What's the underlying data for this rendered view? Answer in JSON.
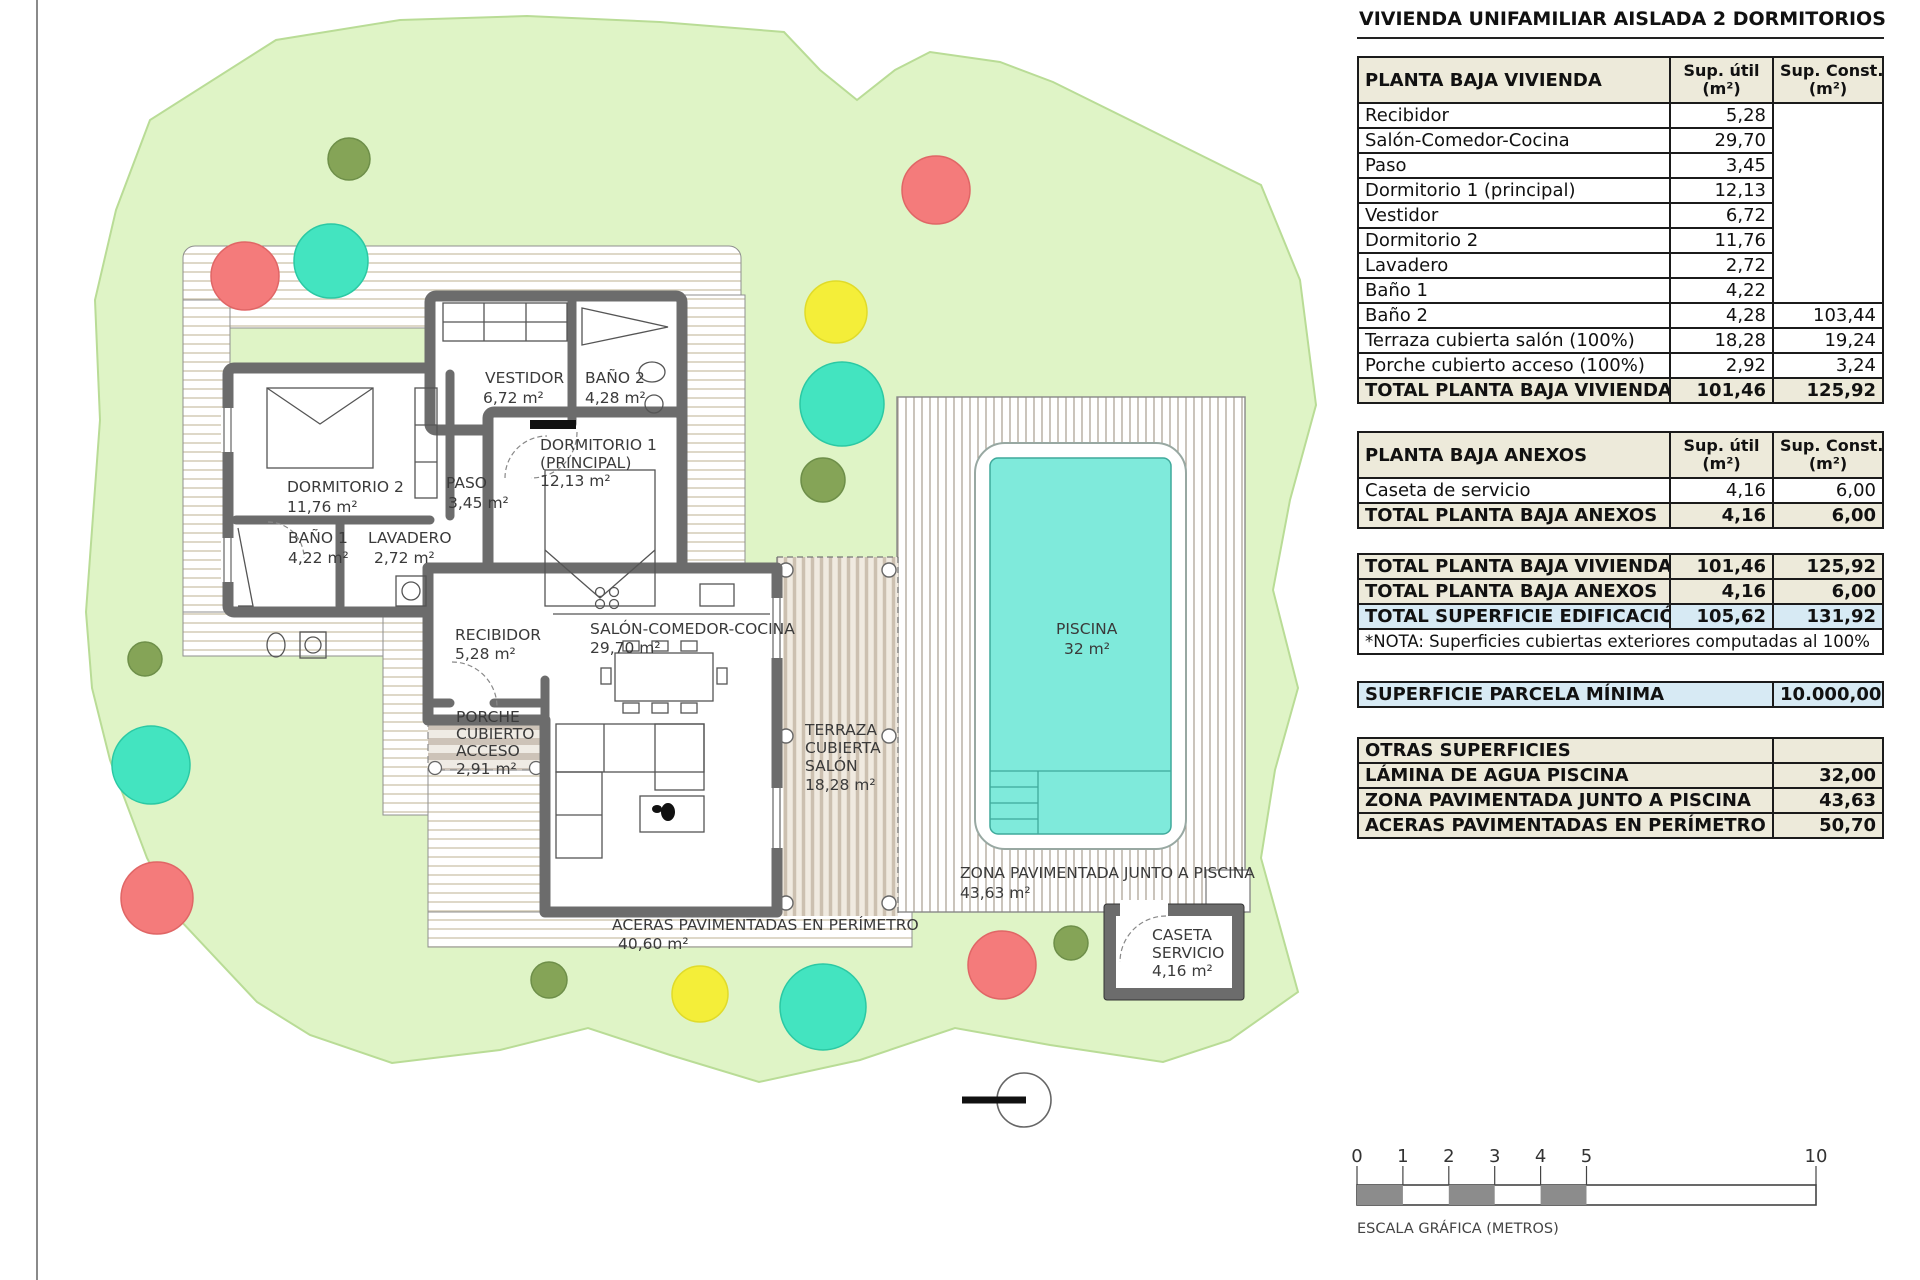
{
  "title": "VIVIENDA UNIFAMILIAR AISLADA 2 DORMITORIOS",
  "tables": {
    "vivienda": {
      "header": {
        "title": "PLANTA BAJA VIVIENDA",
        "util": [
          "Sup. útil",
          "(m²)"
        ],
        "const": [
          "Sup. Const.",
          "(m²)"
        ]
      },
      "rows": [
        {
          "label": "Recibidor",
          "util": "5,28",
          "const": ""
        },
        {
          "label": "Salón-Comedor-Cocina",
          "util": "29,70",
          "const": ""
        },
        {
          "label": "Paso",
          "util": "3,45",
          "const": ""
        },
        {
          "label": "Dormitorio 1 (principal)",
          "util": "12,13",
          "const": ""
        },
        {
          "label": "Vestidor",
          "util": "6,72",
          "const": ""
        },
        {
          "label": "Dormitorio 2",
          "util": "11,76",
          "const": ""
        },
        {
          "label": "Lavadero",
          "util": "2,72",
          "const": ""
        },
        {
          "label": "Baño 1",
          "util": "4,22",
          "const": ""
        },
        {
          "label": "Baño 2",
          "util": "4,28",
          "const": "103,44"
        },
        {
          "label": "Terraza cubierta salón (100%)",
          "util": "18,28",
          "const": "19,24"
        },
        {
          "label": "Porche cubierto acceso (100%)",
          "util": "2,92",
          "const": "3,24"
        }
      ],
      "total": {
        "label": "TOTAL PLANTA BAJA VIVIENDA",
        "util": "101,46",
        "const": "125,92"
      }
    },
    "anexos": {
      "header": {
        "title": "PLANTA BAJA ANEXOS",
        "util": [
          "Sup. útil",
          "(m²)"
        ],
        "const": [
          "Sup. Const.",
          "(m²)"
        ]
      },
      "rows": [
        {
          "label": "Caseta de servicio",
          "util": "4,16",
          "const": "6,00"
        }
      ],
      "total": {
        "label": "TOTAL PLANTA BAJA ANEXOS",
        "util": "4,16",
        "const": "6,00"
      }
    },
    "totales": {
      "rows": [
        {
          "label": "TOTAL PLANTA BAJA VIVIENDA",
          "util": "101,46",
          "const": "125,92",
          "style": "tot"
        },
        {
          "label": "TOTAL PLANTA BAJA ANEXOS",
          "util": "4,16",
          "const": "6,00",
          "style": "tot"
        },
        {
          "label": "TOTAL SUPERFICIE EDIFICACIÓN",
          "util": "105,62",
          "const": "131,92",
          "style": "blue"
        }
      ],
      "nota": "*NOTA: Superficies cubiertas exteriores computadas al 100%"
    },
    "parcela": {
      "label": "SUPERFICIE PARCELA MÍNIMA",
      "value": "10.000,00"
    },
    "otras": {
      "rows": [
        {
          "label": "OTRAS SUPERFICIES",
          "value": ""
        },
        {
          "label": "LÁMINA DE AGUA PISCINA",
          "value": "32,00"
        },
        {
          "label": "ZONA PAVIMENTADA JUNTO A PISCINA",
          "value": "43,63"
        },
        {
          "label": "ACERAS PAVIMENTADAS EN PERÍMETRO",
          "value": "50,70"
        }
      ]
    }
  },
  "plan": {
    "rooms": {
      "dormitorio2": {
        "name": "DORMITORIO 2",
        "area": "11,76 m²"
      },
      "bano1": {
        "name": "BAÑO 1",
        "area": "4,22 m²"
      },
      "lavadero": {
        "name": "LAVADERO",
        "area": "2,72 m²"
      },
      "paso": {
        "name": "PASO",
        "area": "3,45 m²"
      },
      "vestidor": {
        "name": "VESTIDOR",
        "area": "6,72 m²"
      },
      "bano2": {
        "name": "BAÑO 2",
        "area": "4,28 m²"
      },
      "dormitorio1": {
        "line1": "DORMITORIO 1",
        "line2": "(PRINCIPAL)",
        "area": "12,13 m²"
      },
      "recibidor": {
        "name": "RECIBIDOR",
        "area": "5,28 m²"
      },
      "salon": {
        "name": "SALÓN-COMEDOR-COCINA",
        "area": "29,70 m²"
      },
      "porche": {
        "line1": "PORCHE",
        "line2": "CUBIERTO",
        "line3": "ACCESO",
        "area": "2,91 m²"
      },
      "terraza": {
        "line1": "TERRAZA",
        "line2": "CUBIERTA",
        "line3": "SALÓN",
        "area": "18,28 m²"
      },
      "piscina": {
        "name": "PISCINA",
        "area": "32 m²"
      },
      "zona": {
        "name": "ZONA PAVIMENTADA JUNTO A PISCINA",
        "area": "43,63 m²"
      },
      "aceras": {
        "name": "ACERAS PAVIMENTADAS EN PERÍMETRO",
        "area": "40,60 m²"
      },
      "caseta": {
        "line1": "CASETA",
        "line2": "SERVICIO",
        "area": "4,16 m²"
      }
    },
    "scalebar": {
      "ticks": [
        "0",
        "1",
        "2",
        "3",
        "4",
        "5",
        "10"
      ],
      "label": "ESCALA GRÁFICA (METROS)"
    },
    "colors": {
      "parcel_green": "#DFF4C6",
      "pool_water": "#7FEADB",
      "tree_red": "#F47B7B",
      "tree_teal": "#43E4C0",
      "tree_yellow": "#F4EE39",
      "tree_olive": "#85A457",
      "wall_gray": "#6C6C6C",
      "table_beige": "#EDEADA",
      "table_blue": "#D7EAF4"
    }
  }
}
